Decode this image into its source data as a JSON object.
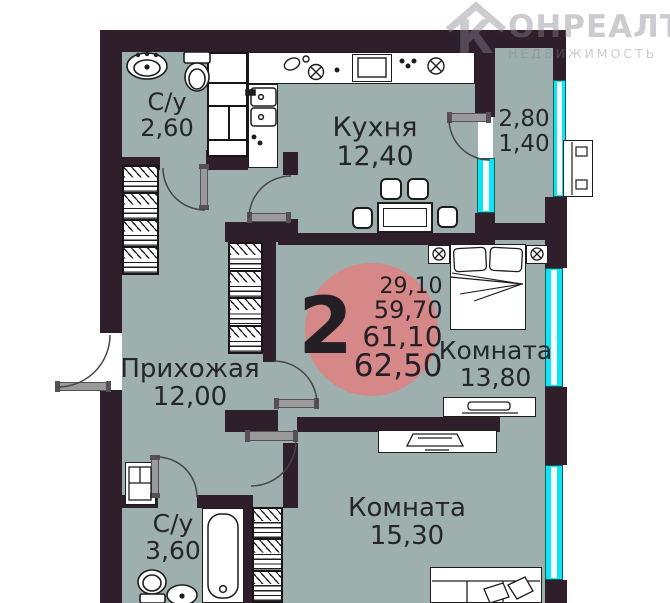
{
  "watermark": {
    "logo_letter": "К",
    "brand": "ОНРЕАЛТ",
    "tagline": "НЕДВИЖИМОСТЬ"
  },
  "badge": {
    "rooms_count": "2",
    "area_lines": [
      "29,10",
      "59,70",
      "61,10",
      "62,50"
    ]
  },
  "rooms": [
    {
      "name": "С/у",
      "area": "2,60"
    },
    {
      "name": "Кухня",
      "area": "12,40"
    },
    {
      "name": "",
      "area": "2,80",
      "area2": "1,40"
    },
    {
      "name": "Комната",
      "area": "13,80"
    },
    {
      "name": "Прихожая",
      "area": "12,00"
    },
    {
      "name": "С/у",
      "area": "3,60"
    },
    {
      "name": "Комната",
      "area": "15,30"
    }
  ]
}
